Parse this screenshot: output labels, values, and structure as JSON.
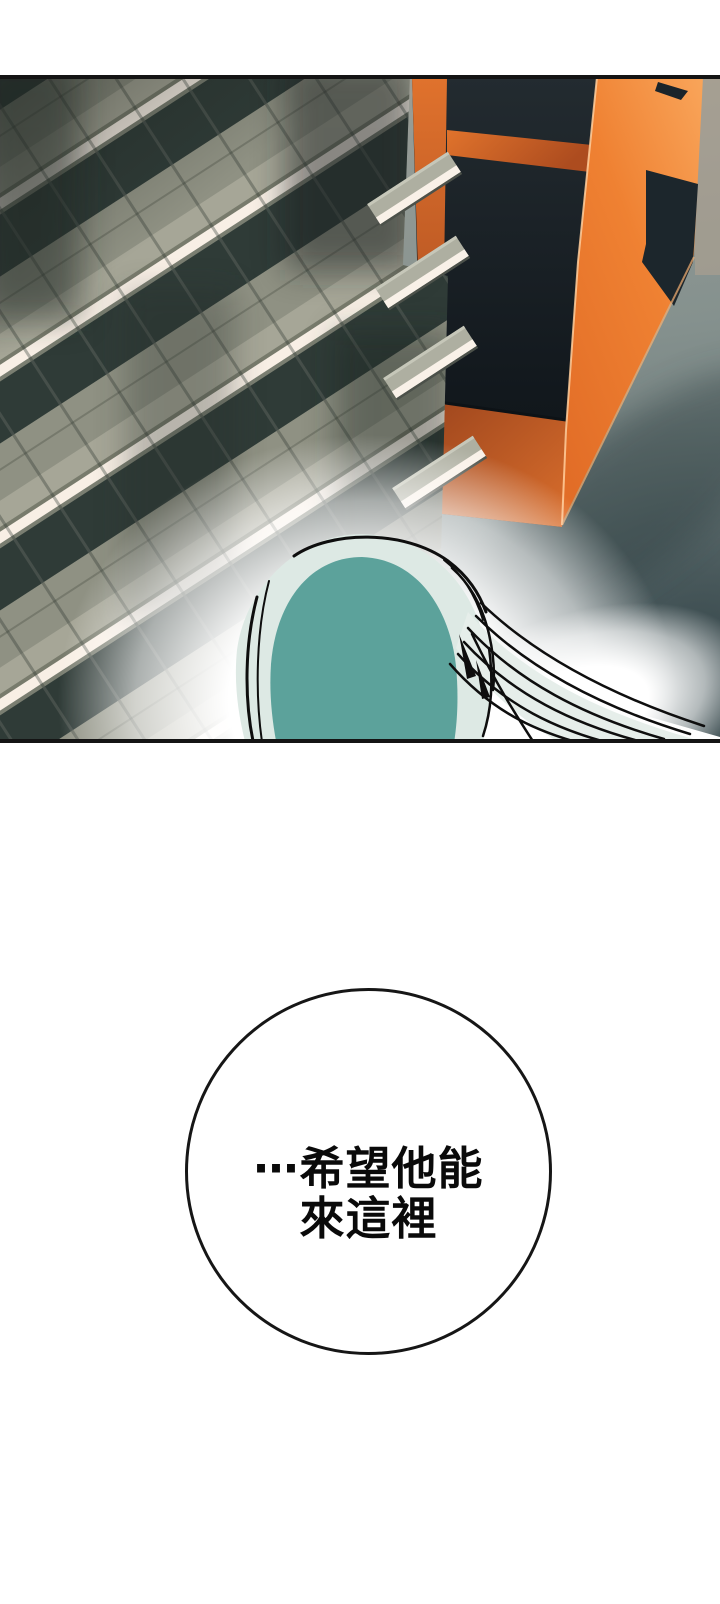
{
  "speech_bubble": {
    "lines": [
      "⋯希望他能",
      "來這裡"
    ]
  },
  "panel": {
    "scene": "aerial-view-of-buildings-and-teal-haired-head",
    "colors": {
      "building_gray_tile": "#8f9183",
      "building_gray_band_dark": "#2f3b37",
      "balcony_stripe_cream": "#f8efe5",
      "building_orange": "#ef8132",
      "building_orange_shadow": "#9d451d",
      "window_dark": "#161e23",
      "street_gray": "#87928f",
      "hair_teal": "#5ca29b",
      "hair_light": "#dde9e4",
      "panel_border": "#141414",
      "glow_white": "#ffffff"
    }
  }
}
